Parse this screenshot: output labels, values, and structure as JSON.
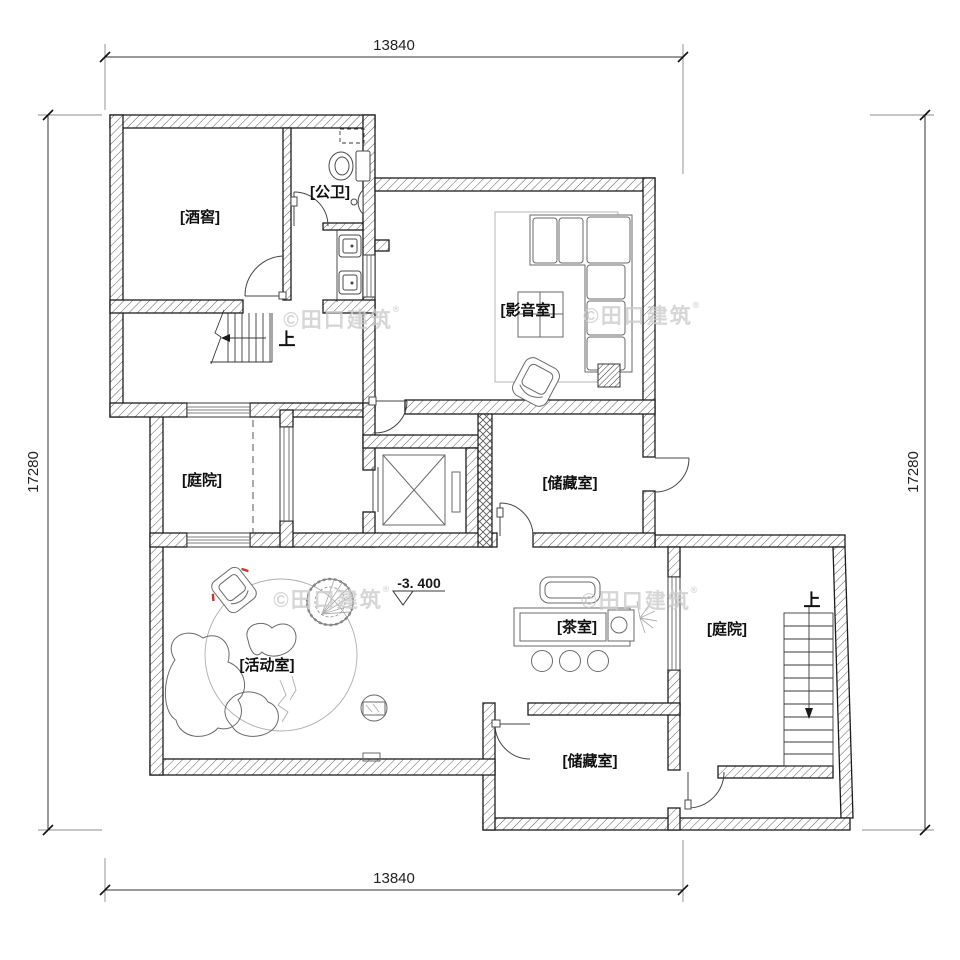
{
  "plan": {
    "rooms": {
      "wine_cellar": "[酒窖]",
      "public_bath": "[公卫]",
      "media_room": "[影音室]",
      "courtyard_left": "[庭院]",
      "storage_upper": "[储藏室]",
      "activity_room": "[活动室]",
      "tea_room": "[茶室]",
      "courtyard_right": "[庭院]",
      "storage_lower": "[储藏室]"
    },
    "stairs": {
      "up_main": "上",
      "up_courtyard": "上"
    },
    "elevation": "-3. 400",
    "dimensions": {
      "top": "13840",
      "bottom": "13840",
      "left": "17280",
      "right": "17280"
    },
    "watermark": {
      "text": "©田口建筑",
      "reg": "®"
    },
    "colors": {
      "wall_line": "#1c1c1c",
      "furniture_line": "#6a6a6a",
      "light_line": "#aeaeae",
      "watermark": "#cccccc",
      "accent_red": "#c0392b",
      "background": "#ffffff"
    }
  }
}
